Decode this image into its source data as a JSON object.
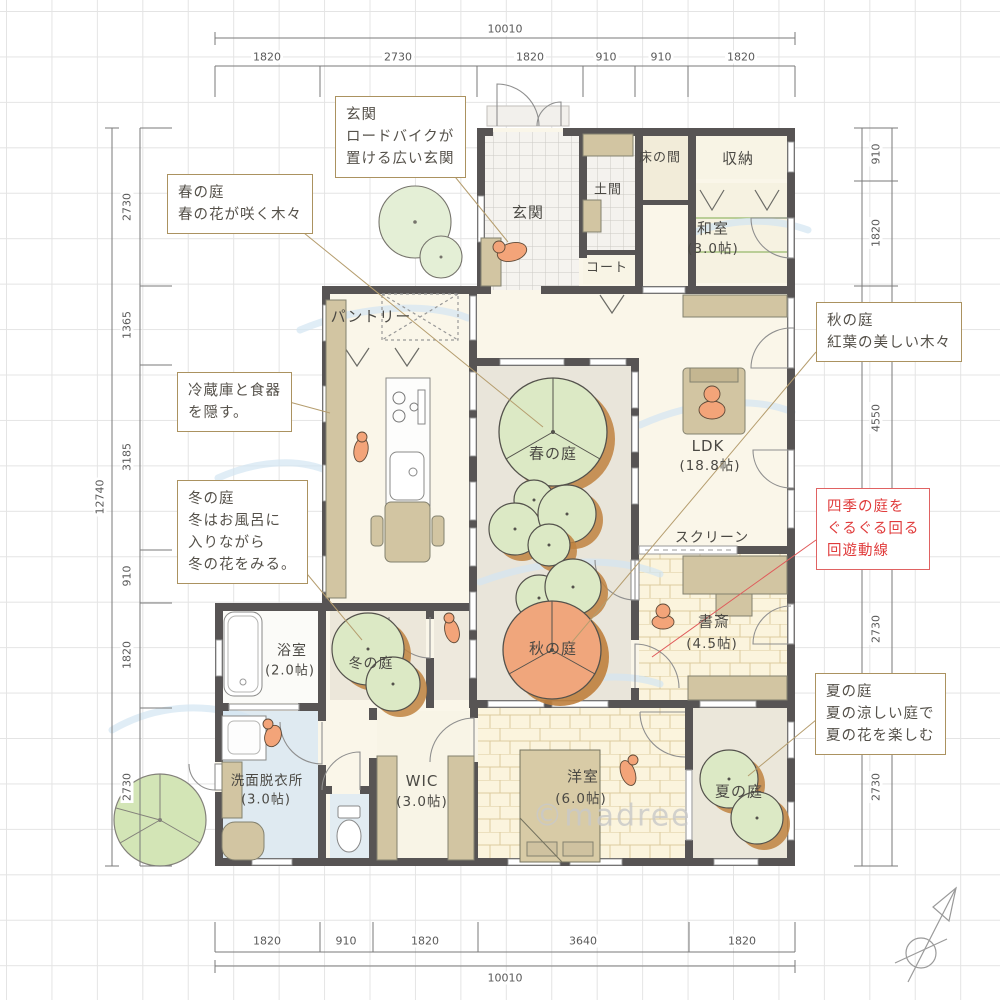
{
  "watermark": "©madree",
  "dimensions": {
    "top_total": "10010",
    "top": [
      "1820",
      "2730",
      "1820",
      "910",
      "910",
      "1820"
    ],
    "bottom": [
      "1820",
      "910",
      "1820",
      "3640",
      "1820"
    ],
    "bottom_total": "10010",
    "left_total": "12740",
    "left": [
      "2730",
      "1365",
      "3185",
      "910",
      "1820",
      "2730"
    ],
    "right": [
      "910",
      "1820",
      "4550",
      "2730",
      "2730"
    ]
  },
  "rooms": {
    "genkan": {
      "label": "玄関"
    },
    "doma": {
      "label": "土間"
    },
    "tokonoma": {
      "label": "床の間"
    },
    "storage": {
      "label": "収納"
    },
    "washitsu": {
      "label": "和室",
      "size": "(3.0帖)"
    },
    "coat": {
      "label": "コート"
    },
    "pantry": {
      "label": "パントリー"
    },
    "ldk": {
      "label": "LDK",
      "size": "(18.8帖)"
    },
    "screen": {
      "label": "スクリーン"
    },
    "study": {
      "label": "書斎",
      "size": "(4.5帖)"
    },
    "spring_garden": {
      "label": "春の庭"
    },
    "autumn_garden": {
      "label": "秋の庭"
    },
    "winter_garden": {
      "label": "冬の庭"
    },
    "summer_garden": {
      "label": "夏の庭"
    },
    "bathroom": {
      "label": "浴室",
      "size": "(2.0帖)"
    },
    "washroom": {
      "label": "洗面脱衣所",
      "size": "(3.0帖)"
    },
    "wic": {
      "label": "WIC",
      "size": "(3.0帖)"
    },
    "bedroom": {
      "label": "洋室",
      "size": "(6.0帖)"
    }
  },
  "annotations": {
    "genkan_note": {
      "lines": [
        "玄関",
        "ロードバイクが",
        "置ける広い玄関"
      ]
    },
    "spring_note": {
      "lines": [
        "春の庭",
        "春の花が咲く木々"
      ]
    },
    "fridge_note": {
      "lines": [
        "冷蔵庫と食器",
        "を隠す。"
      ]
    },
    "winter_note": {
      "lines": [
        "冬の庭",
        "冬はお風呂に",
        "入りながら",
        "冬の花をみる。"
      ]
    },
    "autumn_note": {
      "lines": [
        "秋の庭",
        "紅葉の美しい木々"
      ]
    },
    "circulation_note": {
      "lines": [
        "四季の庭を",
        "ぐるぐる回る",
        "回遊動線"
      ]
    },
    "summer_note": {
      "lines": [
        "夏の庭",
        "夏の涼しい庭で",
        "夏の花を楽しむ"
      ]
    }
  },
  "colors": {
    "wall": "#575454",
    "floor_cream": "#faf6e9",
    "courtyard": "#e9e5da",
    "tree_green": "#dce9c5",
    "tree_autumn": "#f0a67c",
    "tree_shadow": "#c0823f",
    "figure_orange": "#f3a479",
    "callout_border": "#ab9260",
    "accent_red": "#e03c3c",
    "water_blue": "#d3e6f2"
  }
}
